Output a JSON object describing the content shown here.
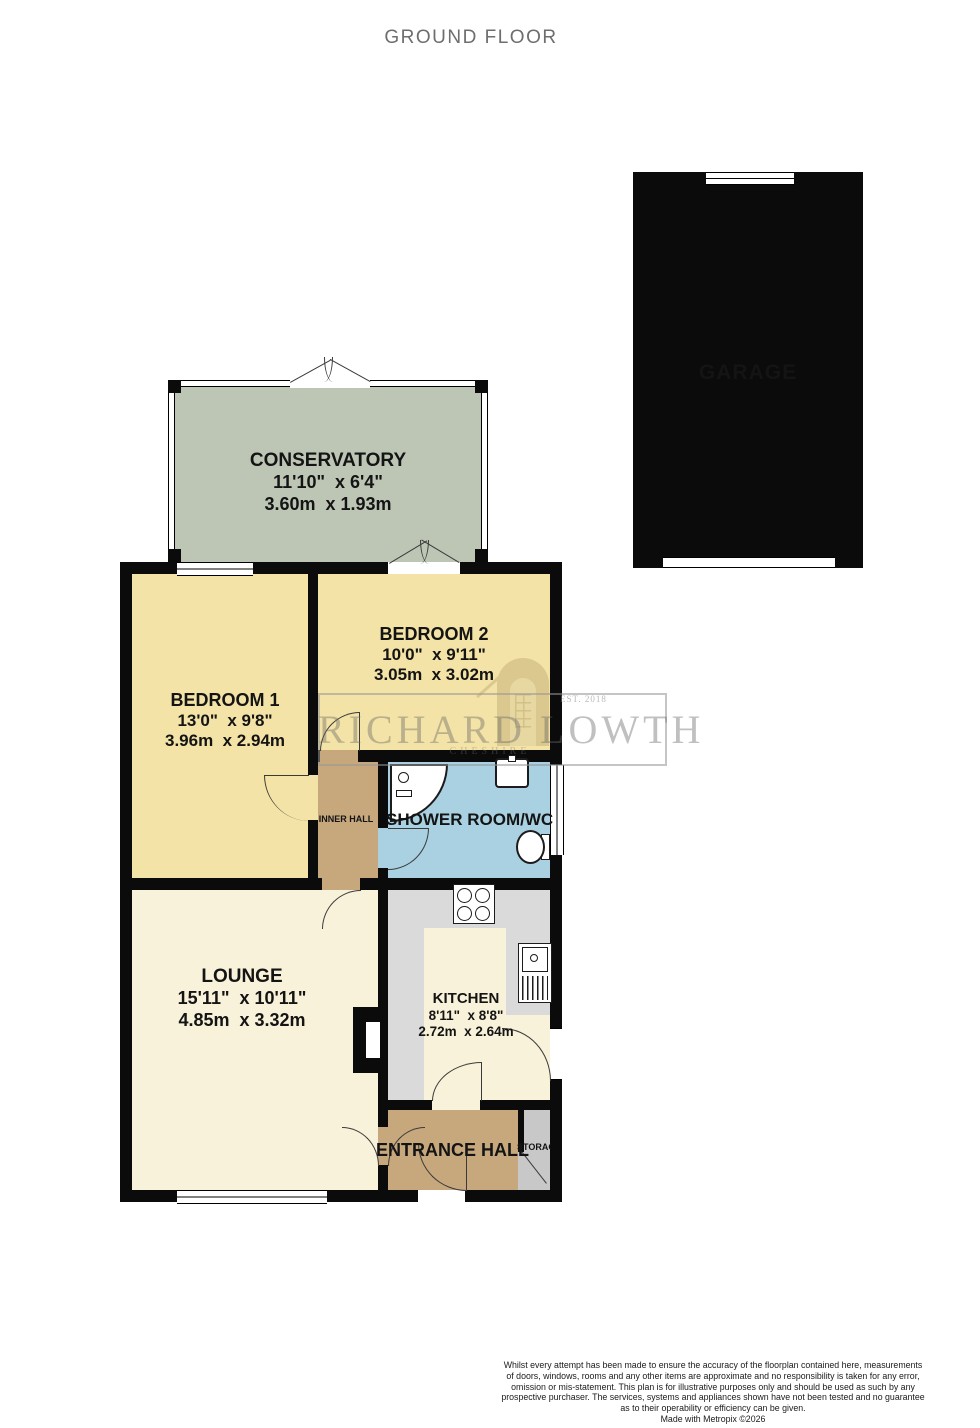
{
  "title": "GROUND FLOOR",
  "rooms": {
    "garage": {
      "name": "GARAGE"
    },
    "conservatory": {
      "name": "CONSERVATORY",
      "imperial": "11'10\"  x 6'4\"",
      "metric": "3.60m  x 1.93m"
    },
    "bedroom1": {
      "name": "BEDROOM 1",
      "imperial": "13'0\"  x 9'8\"",
      "metric": "3.96m  x 2.94m"
    },
    "bedroom2": {
      "name": "BEDROOM 2",
      "imperial": "10'0\"  x 9'11\"",
      "metric": "3.05m  x 3.02m"
    },
    "inner_hall": {
      "name": "INNER HALL"
    },
    "shower_room": {
      "name": "SHOWER ROOM/WC"
    },
    "lounge": {
      "name": "LOUNGE",
      "imperial": "15'11\"  x 10'11\"",
      "metric": "4.85m  x 3.32m"
    },
    "kitchen": {
      "name": "KITCHEN",
      "imperial": "8'11\"  x 8'8\"",
      "metric": "2.72m  x 2.64m"
    },
    "entrance_hall": {
      "name": "ENTRANCE HALL"
    },
    "storage": {
      "name": "STORAGE"
    }
  },
  "watermark": {
    "agency": "RICHARD LOWTH",
    "region": "CHESHIRE",
    "established": "EST. 2018"
  },
  "footer": {
    "lines": [
      "Whilst every attempt has been made to ensure the accuracy of the floorplan contained here, measurements",
      "of doors, windows, rooms and any other items are approximate and no responsibility is taken for any error,",
      "omission or mis-statement. This plan is for illustrative purposes only and should be used as such by any",
      "prospective purchaser. The services, systems and appliances shown have not been tested and no guarantee",
      "as to their operability or efficiency can be given.",
      "Made with Metropix ©2026"
    ]
  },
  "colors": {
    "wall": "#0b0b0b",
    "bedroom_yellow": "#f4e3a6",
    "lounge_cream": "#f9f2da",
    "conservatory_sage": "#bdc6b5",
    "garage_orange": "#e9b488",
    "hall_brown": "#c7a87c",
    "shower_blue": "#a9d1e1",
    "storage_gray": "#c8c8c8",
    "counter_gray": "#dadada",
    "title_gray": "#6e6e6e"
  }
}
